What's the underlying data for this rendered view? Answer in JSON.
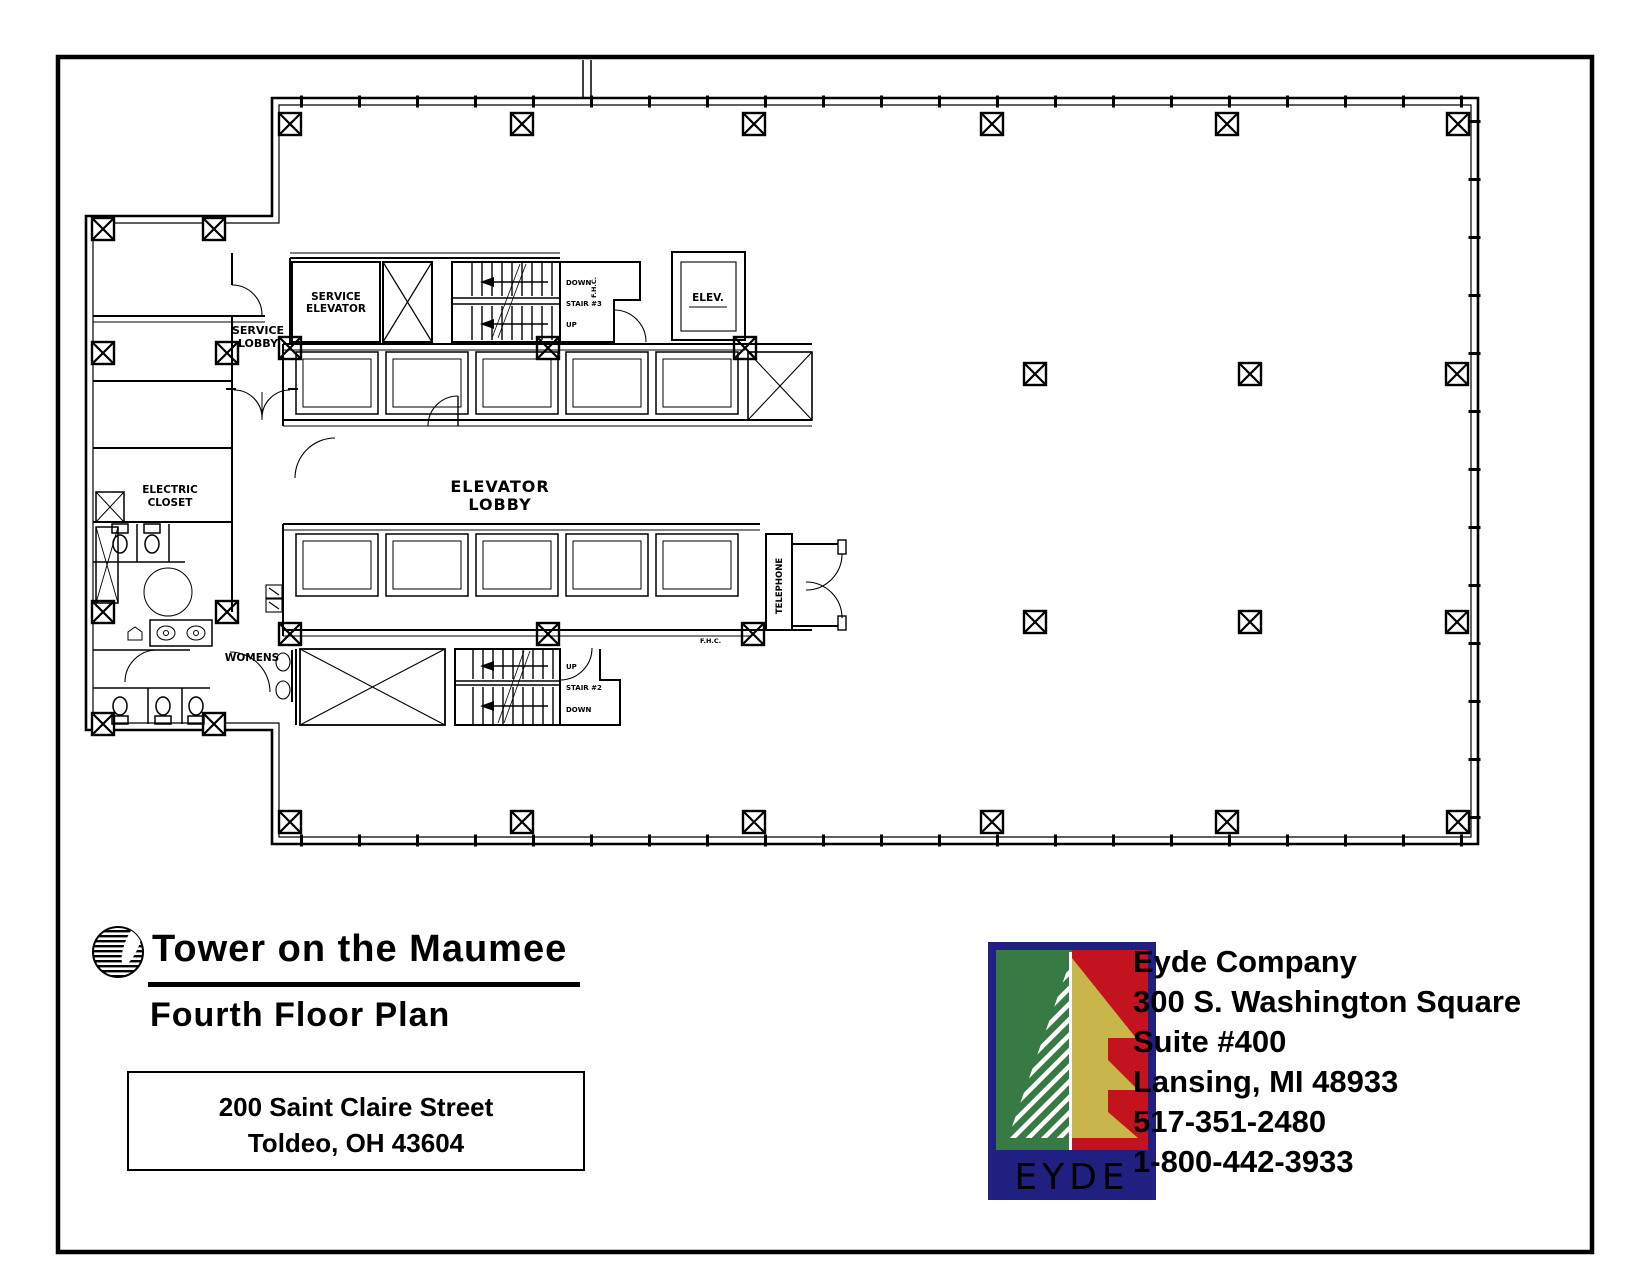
{
  "floor_plan": {
    "labels": {
      "service_lobby_line1": "SERVICE",
      "service_lobby_line2": "LOBBY",
      "service_elevator_line1": "SERVICE",
      "service_elevator_line2": "ELEVATOR",
      "elevator_room": "ELEV.",
      "elevator_lobby_line1": "ELEVATOR",
      "elevator_lobby_line2": "LOBBY",
      "electric_closet_line1": "ELECTRIC",
      "electric_closet_line2": "CLOSET",
      "womens": "WOMENS",
      "telephone": "TELEPHONE",
      "stair3_name": "STAIR #3",
      "stair3_up": "UP",
      "stair3_down": "DOWN",
      "stair3_fhc": "F.H.C.",
      "stair2_name": "STAIR #2",
      "stair2_up": "UP",
      "stair2_down": "DOWN",
      "fhc_lower": "F.H.C."
    }
  },
  "title_block": {
    "title": "Tower on the Maumee",
    "subtitle": "Fourth Floor Plan",
    "address_line1": "200 Saint Claire Street",
    "address_line2": "Toldeo, OH 43604"
  },
  "company_block": {
    "logo_text": "EYDE",
    "name": "Eyde Company",
    "address_line1": "300 S. Washington Square",
    "address_line2": "Suite #400",
    "address_line3": "Lansing, MI 48933",
    "phone_local": "517-351-2480",
    "phone_tollfree": "1-800-442-3933",
    "colors": {
      "navy": "#1f2080",
      "green": "#377a44",
      "red": "#c2131f",
      "gold": "#c9b64b",
      "white": "#ffffff"
    }
  }
}
